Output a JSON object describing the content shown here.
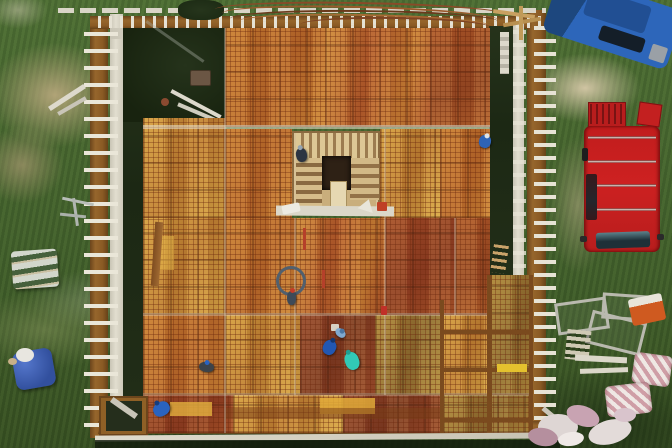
{
  "scene": {
    "description": "Top-down aerial drone photo of a building under construction: timber formwork deck covered in reinforcement mesh over orange plywood panels, with a central stairwell opening, edge formwork with white form ties, workers on the slab, two vans parked on grass and construction materials scattered around",
    "environment": "grass field with dirt and gravel patches",
    "people_count": 8,
    "vehicles": [
      "blue van (top right, parked at an angle)",
      "red van with roof rack (right side, parked vertically)"
    ],
    "objects": [
      "rebar bar bundle along top edge",
      "stairwell opening with wooden joists and dark hatch",
      "coiled hose on deck",
      "pink insulation bales",
      "metal scaffold frames",
      "pallet with sacks",
      "blue tarp pile",
      "white walkway planks",
      "debris pile of pink/white wrap"
    ]
  },
  "colors": {
    "grass": "#47642e",
    "grass_dark": "#2e441f",
    "dirt": "#b3a37e",
    "gravel": "#d2c5a4",
    "deck_orange": "#c57a31",
    "deck_rust": "#a85427",
    "deck_gold": "#d29d3e",
    "deck_red": "#9c4526",
    "deck_olive": "#a08136",
    "frame_brown": "#8f6026",
    "beam_white": "#ddd8ca",
    "van_blue": "#2d66ba",
    "van_red": "#cd2121",
    "teal": "#31c9b6",
    "worker_blue": "#2a63c0",
    "insulation_pink": "#cda0a6",
    "stair_tan": "#c9ae7c",
    "hole_dark": "#2e2115"
  },
  "workers": [
    {
      "name": "worker-at-stairwell",
      "x": 296,
      "y": 148,
      "w": 11,
      "h": 14,
      "color": "#2c3442",
      "accent": "#95a5b2",
      "rot": -10
    },
    {
      "name": "worker-right-edge",
      "x": 479,
      "y": 135,
      "w": 12,
      "h": 13,
      "color": "#2e63b6",
      "accent": "#dfe3e8",
      "rot": 15
    },
    {
      "name": "worker-with-hose",
      "x": 287,
      "y": 291,
      "w": 9,
      "h": 14,
      "color": "#3e4a58",
      "accent": "#c23c28",
      "rot": 0
    },
    {
      "name": "worker-blue-kneeling",
      "x": 323,
      "y": 340,
      "w": 13,
      "h": 15,
      "color": "#2257b2",
      "accent": "#16366e",
      "rot": 25
    },
    {
      "name": "worker-teal",
      "x": 345,
      "y": 352,
      "w": 14,
      "h": 18,
      "color": "#31c9b6",
      "accent": "#1f9f92",
      "rot": -20
    },
    {
      "name": "worker-light-blue",
      "x": 335,
      "y": 329,
      "w": 11,
      "h": 8,
      "color": "#7fa9cf",
      "accent": "#4a76a2",
      "rot": 40
    },
    {
      "name": "worker-bent-dark",
      "x": 199,
      "y": 362,
      "w": 15,
      "h": 10,
      "color": "#3c434a",
      "accent": "#2a63c0",
      "rot": 8
    },
    {
      "name": "worker-bottom-blue",
      "x": 153,
      "y": 402,
      "w": 17,
      "h": 14,
      "color": "#2a63c0",
      "accent": "#173d7e",
      "rot": -30
    }
  ]
}
